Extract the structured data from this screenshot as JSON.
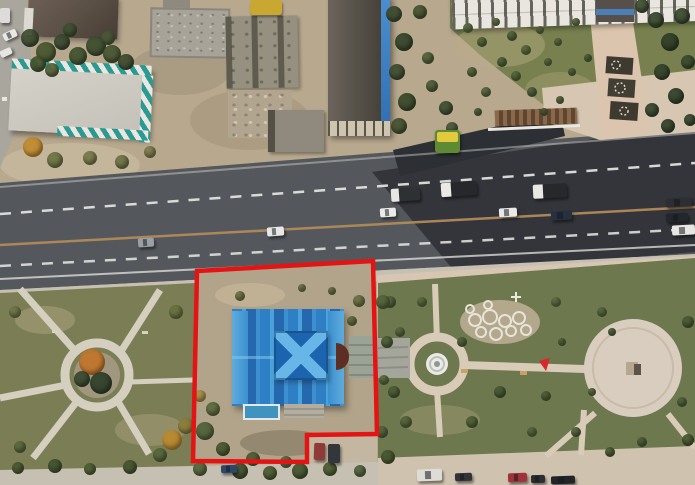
{
  "scene": {
    "type": "aerial-drone-photo",
    "description": "Top-down drone photo of a city block: industrial buildings and a demolition site at top-left, a long dark-roofed building with a blue edge at top-center, a white apartment block with an ornamental walkway and gardens at top-right, a multi-lane road with cars and dump trucks plus fresh black asphalt being laid, a landscaped park with an X-shaped path ring at bottom-left, a paved park with a fountain circle and a large round plaza at bottom-right, and a red-outlined land plot containing a bright blue-roofed church-like building in the center.",
    "annotation": {
      "label": "land-plot-boundary",
      "color": "#e41414",
      "points": [
        [
          197,
          271
        ],
        [
          373,
          261
        ],
        [
          377,
          434
        ],
        [
          307,
          435
        ],
        [
          307,
          462
        ],
        [
          193,
          461
        ]
      ]
    }
  },
  "colors": {
    "annotation-red": "#e41414",
    "dirt": "#b7a88e",
    "plot-dirt": "#b2a48a",
    "grass-left": "#7b7e55",
    "grass-right": "#6d784e",
    "asphalt": "#54575c",
    "asphalt-new": "#303338",
    "paving-beige": "#d6c6b2",
    "path-grey": "#d5cfc0",
    "teal-stripe": "#2a9a93",
    "roof-blue": "#2f7fc5",
    "roof-blue-dark": "#1c64ad",
    "roof-x-light": "#68b6e8",
    "lane-line": "#e9e9e4",
    "center-line": "#b08a5a"
  },
  "vehicles": [
    {
      "name": "car-grey",
      "x": 138,
      "y": 238,
      "w": 16,
      "h": 9,
      "rot": -4,
      "c": "#9aa0a6"
    },
    {
      "name": "car-white",
      "x": 267,
      "y": 227,
      "w": 17,
      "h": 9,
      "rot": -4,
      "c": "#e8e8e6"
    },
    {
      "name": "car-white",
      "x": 380,
      "y": 208,
      "w": 16,
      "h": 9,
      "rot": -4,
      "c": "#eceae8"
    },
    {
      "name": "dump-truck",
      "x": 391,
      "y": 188,
      "w": 29,
      "h": 13,
      "rot": -4,
      "c": "#2e3134",
      "cab": "#e6e6e4"
    },
    {
      "name": "dump-truck",
      "x": 441,
      "y": 182,
      "w": 36,
      "h": 14,
      "rot": -4,
      "c": "#26282c",
      "cab": "#eae9e6"
    },
    {
      "name": "dump-truck",
      "x": 533,
      "y": 184,
      "w": 34,
      "h": 14,
      "rot": -3,
      "c": "#26282c",
      "cab": "#e9e8e5"
    },
    {
      "name": "car-white",
      "x": 499,
      "y": 208,
      "w": 18,
      "h": 9,
      "rot": -3,
      "c": "#e9e9e7"
    },
    {
      "name": "car-dark-blue",
      "x": 551,
      "y": 211,
      "w": 21,
      "h": 9,
      "rot": -3,
      "c": "#27303f"
    },
    {
      "name": "car-dark",
      "x": 666,
      "y": 198,
      "w": 26,
      "h": 9,
      "rot": -3,
      "c": "#2b2e33"
    },
    {
      "name": "car-dark",
      "x": 666,
      "y": 213,
      "w": 22,
      "h": 9,
      "rot": -3,
      "c": "#23262b"
    },
    {
      "name": "car-white",
      "x": 672,
      "y": 225,
      "w": 23,
      "h": 10,
      "rot": -3,
      "c": "#e8e7e3"
    },
    {
      "name": "parked-car-blue",
      "x": 221,
      "y": 465,
      "w": 16,
      "h": 8,
      "rot": -2,
      "c": "#2e4668"
    },
    {
      "name": "parked-car-red",
      "x": 314,
      "y": 443,
      "w": 11,
      "h": 17,
      "rot": 2,
      "c": "#8e3a38"
    },
    {
      "name": "parked-car-dark",
      "x": 328,
      "y": 444,
      "w": 12,
      "h": 19,
      "rot": 0,
      "c": "#33363b"
    },
    {
      "name": "parked-truck-white",
      "x": 417,
      "y": 469,
      "w": 25,
      "h": 12,
      "rot": -2,
      "c": "#dedcd6"
    },
    {
      "name": "parked-car-dark",
      "x": 455,
      "y": 473,
      "w": 17,
      "h": 8,
      "rot": -2,
      "c": "#303338"
    },
    {
      "name": "parked-car-red",
      "x": 508,
      "y": 473,
      "w": 19,
      "h": 9,
      "rot": -2,
      "c": "#a03339"
    },
    {
      "name": "parked-car-dark",
      "x": 531,
      "y": 475,
      "w": 14,
      "h": 8,
      "rot": -2,
      "c": "#2a2d32"
    },
    {
      "name": "parked-car-dark",
      "x": 551,
      "y": 476,
      "w": 24,
      "h": 8,
      "rot": -2,
      "c": "#212429"
    },
    {
      "name": "parked-car-white",
      "x": 3,
      "y": 31,
      "w": 14,
      "h": 8,
      "rot": -25,
      "c": "#e9e8e4"
    },
    {
      "name": "parked-car-white",
      "x": 0,
      "y": 49,
      "w": 12,
      "h": 7,
      "rot": -25,
      "c": "#e6e5e1"
    },
    {
      "name": "parked-van-white",
      "x": 0,
      "y": 8,
      "w": 10,
      "h": 15,
      "rot": 0,
      "c": "#dedcd8"
    }
  ],
  "trees": [
    [
      30,
      38,
      9,
      "#3e4c31"
    ],
    [
      46,
      52,
      10,
      "#46552f"
    ],
    [
      62,
      42,
      8,
      "#3a4930"
    ],
    [
      78,
      56,
      9,
      "#42512f"
    ],
    [
      96,
      46,
      10,
      "#3c4c2e"
    ],
    [
      112,
      54,
      9,
      "#465433"
    ],
    [
      126,
      62,
      8,
      "#3d4a2e"
    ],
    [
      108,
      38,
      7,
      "#4a5835"
    ],
    [
      38,
      64,
      8,
      "#44522f"
    ],
    [
      70,
      30,
      7,
      "#3f4e31"
    ],
    [
      52,
      70,
      7,
      "#57653c"
    ],
    [
      33,
      147,
      10,
      "#c08a30"
    ],
    [
      55,
      160,
      8,
      "#6b7342"
    ],
    [
      90,
      158,
      7,
      "#77784a"
    ],
    [
      122,
      162,
      7,
      "#6e7245"
    ],
    [
      150,
      152,
      6,
      "#7d7b4c"
    ],
    [
      394,
      14,
      8,
      "#3c4a2f"
    ],
    [
      404,
      42,
      9,
      "#35432b"
    ],
    [
      397,
      72,
      8,
      "#3e4c30"
    ],
    [
      407,
      102,
      9,
      "#394728"
    ],
    [
      399,
      126,
      8,
      "#42502f"
    ],
    [
      420,
      12,
      7,
      "#46522f"
    ],
    [
      428,
      58,
      6,
      "#51603a"
    ],
    [
      446,
      108,
      7,
      "#3f4d2f"
    ],
    [
      452,
      128,
      6,
      "#49573a"
    ],
    [
      432,
      86,
      6,
      "#4b5a36"
    ],
    [
      468,
      28,
      5,
      "#5a6a3e"
    ],
    [
      482,
      42,
      5,
      "#52623a"
    ],
    [
      496,
      22,
      4,
      "#5e6c40"
    ],
    [
      512,
      36,
      5,
      "#50603a"
    ],
    [
      526,
      50,
      5,
      "#57673c"
    ],
    [
      540,
      30,
      4,
      "#5c6a3e"
    ],
    [
      502,
      62,
      5,
      "#4e5e38"
    ],
    [
      516,
      76,
      5,
      "#55653b"
    ],
    [
      532,
      92,
      5,
      "#505f39"
    ],
    [
      548,
      62,
      4,
      "#5a693d"
    ],
    [
      472,
      72,
      5,
      "#51613a"
    ],
    [
      486,
      92,
      5,
      "#57663c"
    ],
    [
      478,
      112,
      4,
      "#4f5f38"
    ],
    [
      558,
      42,
      4,
      "#5b6a3e"
    ],
    [
      572,
      72,
      4,
      "#53633a"
    ],
    [
      576,
      22,
      4,
      "#5e6c40"
    ],
    [
      588,
      58,
      4,
      "#50603a"
    ],
    [
      560,
      100,
      4,
      "#57663c"
    ],
    [
      544,
      112,
      4,
      "#4f5e38"
    ],
    [
      656,
      20,
      8,
      "#36452c"
    ],
    [
      670,
      42,
      9,
      "#2f3e27"
    ],
    [
      682,
      16,
      8,
      "#38472d"
    ],
    [
      662,
      72,
      8,
      "#33422a"
    ],
    [
      676,
      96,
      8,
      "#2f3e27"
    ],
    [
      688,
      62,
      7,
      "#3a492e"
    ],
    [
      652,
      110,
      7,
      "#35442b"
    ],
    [
      668,
      126,
      7,
      "#31402a"
    ],
    [
      642,
      6,
      7,
      "#3c4b2f"
    ],
    [
      690,
      120,
      6,
      "#36452c"
    ],
    [
      92,
      362,
      13,
      "#bf752c"
    ],
    [
      101,
      383,
      11,
      "#2f3f2a"
    ],
    [
      82,
      379,
      8,
      "#394830"
    ],
    [
      15,
      312,
      6,
      "#6e7547"
    ],
    [
      176,
      312,
      7,
      "#68703f"
    ],
    [
      20,
      447,
      6,
      "#5a683c"
    ],
    [
      172,
      440,
      10,
      "#b9892e"
    ],
    [
      186,
      426,
      8,
      "#8c7c3c"
    ],
    [
      160,
      455,
      7,
      "#56663a"
    ],
    [
      18,
      468,
      6,
      "#49582f"
    ],
    [
      55,
      466,
      7,
      "#42512e"
    ],
    [
      90,
      469,
      6,
      "#4d5c33"
    ],
    [
      130,
      467,
      7,
      "#44532f"
    ],
    [
      200,
      469,
      7,
      "#53633a"
    ],
    [
      240,
      471,
      8,
      "#3f4f2d"
    ],
    [
      270,
      473,
      7,
      "#49592f"
    ],
    [
      300,
      471,
      8,
      "#42522e"
    ],
    [
      330,
      469,
      7,
      "#4b5a31"
    ],
    [
      360,
      471,
      6,
      "#51613a"
    ],
    [
      205,
      431,
      9,
      "#50603a"
    ],
    [
      213,
      409,
      7,
      "#5a693e"
    ],
    [
      200,
      396,
      6,
      "#a98f44"
    ],
    [
      223,
      449,
      7,
      "#46552f"
    ],
    [
      359,
      301,
      6,
      "#68703f"
    ],
    [
      352,
      321,
      5,
      "#5e6a3c"
    ],
    [
      240,
      296,
      5,
      "#6d7444"
    ],
    [
      302,
      288,
      4,
      "#717748"
    ],
    [
      332,
      291,
      4,
      "#6a7142"
    ],
    [
      253,
      459,
      7,
      "#4b5a31"
    ],
    [
      286,
      462,
      6,
      "#52623a"
    ],
    [
      390,
      302,
      6,
      "#51613a"
    ],
    [
      400,
      332,
      5,
      "#56663c"
    ],
    [
      394,
      392,
      6,
      "#4c5c36"
    ],
    [
      406,
      422,
      6,
      "#53633a"
    ],
    [
      422,
      302,
      5,
      "#5a693d"
    ],
    [
      462,
      342,
      5,
      "#50603a"
    ],
    [
      500,
      392,
      6,
      "#485833"
    ],
    [
      472,
      422,
      6,
      "#4f5f38"
    ],
    [
      532,
      432,
      5,
      "#55653b"
    ],
    [
      556,
      302,
      5,
      "#5e6c40"
    ],
    [
      562,
      342,
      4,
      "#53633a"
    ],
    [
      602,
      312,
      5,
      "#57673c"
    ],
    [
      612,
      332,
      4,
      "#50603a"
    ],
    [
      688,
      322,
      6,
      "#4a5a34"
    ],
    [
      682,
      402,
      5,
      "#51613a"
    ],
    [
      642,
      442,
      5,
      "#4d5d36"
    ],
    [
      592,
      392,
      4,
      "#5a693d"
    ],
    [
      576,
      432,
      5,
      "#52623a"
    ],
    [
      546,
      396,
      5,
      "#4e5e38"
    ],
    [
      610,
      452,
      5,
      "#4a5a34"
    ],
    [
      688,
      440,
      6,
      "#46562f"
    ],
    [
      383,
      302,
      7,
      "#55643a"
    ],
    [
      387,
      342,
      6,
      "#4d5c35"
    ],
    [
      382,
      432,
      6,
      "#52623a"
    ],
    [
      388,
      457,
      7,
      "#45552e"
    ],
    [
      384,
      380,
      5,
      "#5a693d"
    ]
  ]
}
